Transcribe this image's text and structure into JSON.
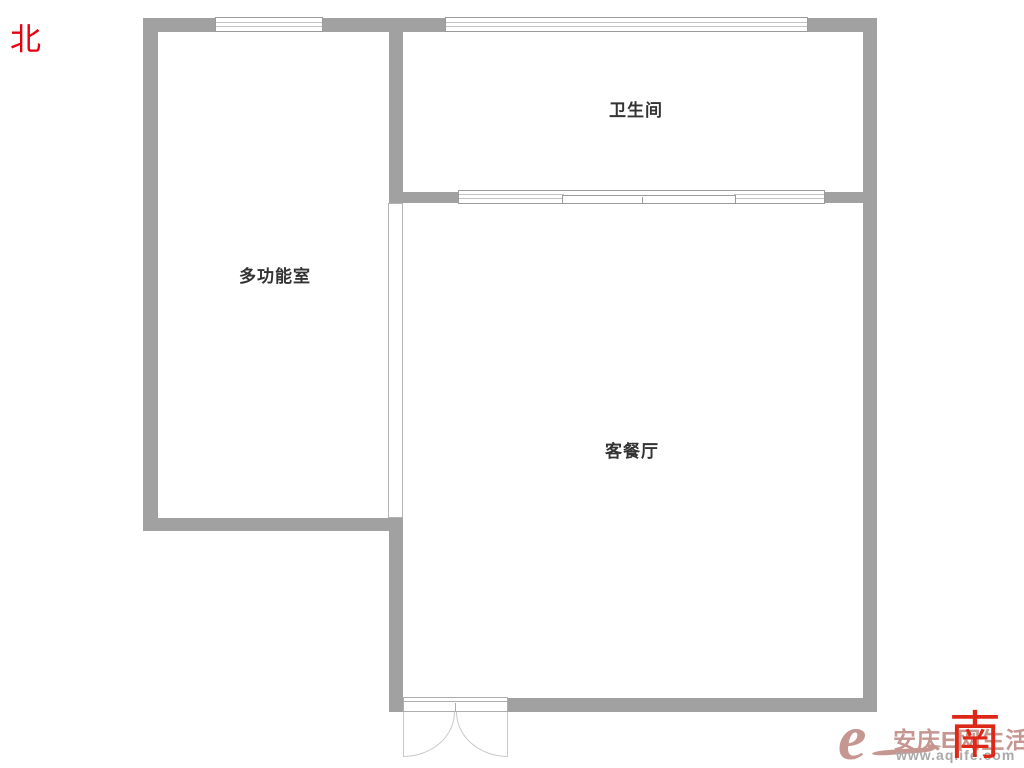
{
  "page": {
    "type": "apartment-floor-plan"
  },
  "compass": {
    "north_label": "北",
    "south_label": "南"
  },
  "rooms": [
    {
      "name": "bathroom",
      "label": "卫生间"
    },
    {
      "name": "multi-function-room",
      "label": "多功能室"
    },
    {
      "name": "living-dining-room",
      "label": "客餐厅"
    }
  ],
  "fixtures": {
    "windows": [
      "multi-function-room-window",
      "bathroom-window",
      "living-room-sliding-window"
    ],
    "doors": [
      "entry-double-door-south"
    ],
    "partitions": [
      "glass-partition-between-multi-function-and-living"
    ]
  },
  "watermark": {
    "logo_letter": "e",
    "site_name": "安庆E网生活",
    "site_url": "www.aqlife.com"
  },
  "colors": {
    "wall": "#a1a1a1",
    "window_frame": "#9b9b9b",
    "room_label": "#333333",
    "compass_north": "#e60012",
    "compass_south": "#de2817",
    "watermark_brand": "#c69790",
    "watermark_url": "#a9a9a9"
  }
}
